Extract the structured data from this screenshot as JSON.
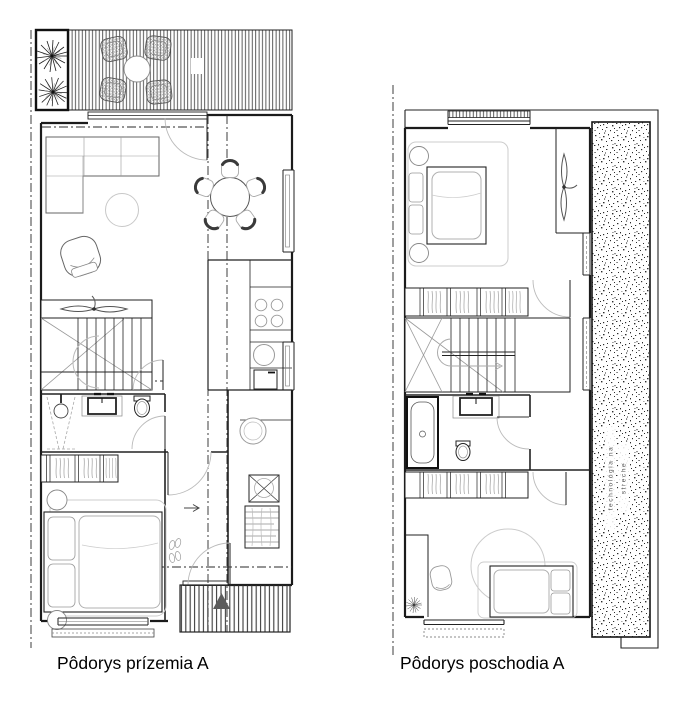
{
  "sheet": {
    "background": "#ffffff"
  },
  "colors": {
    "wall": "#1b1b1b",
    "furniture": "#999999",
    "light_furniture": "#c8c8c8",
    "entrance_arrow": "#5c5c5c"
  },
  "plans": {
    "ground": {
      "label": "Pôdorys prízemia A"
    },
    "upper": {
      "label": "Pôdorys poschodia A",
      "roof_note": {
        "line1": "technológia na",
        "line2": "streche"
      }
    }
  }
}
